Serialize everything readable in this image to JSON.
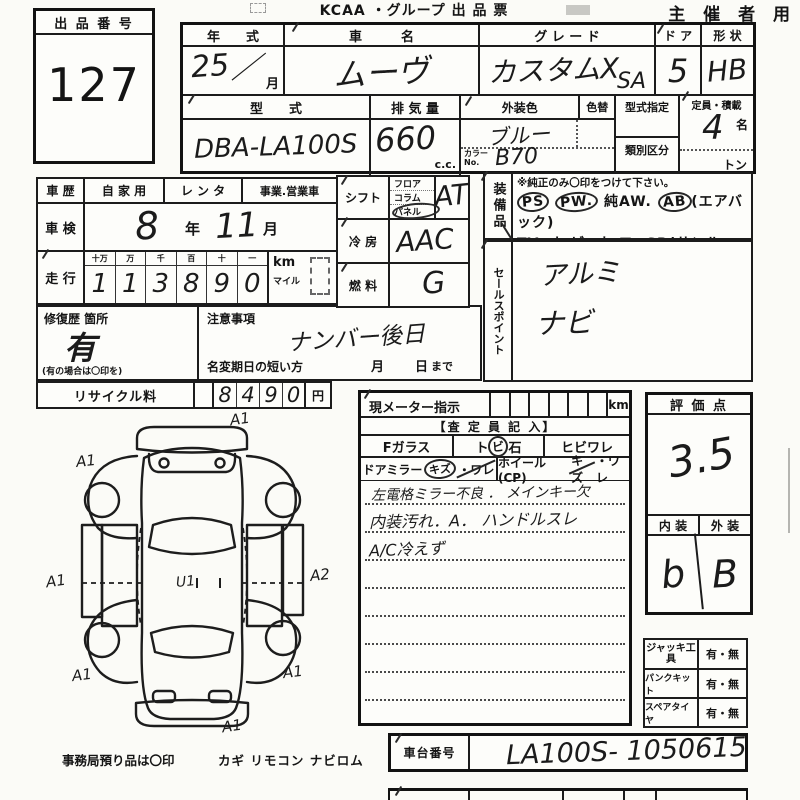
{
  "header": {
    "lot_label": "出 品 番 号",
    "lot_number": "127",
    "title": "KCAA ・グループ 出 品 票",
    "organizer": "主 催 者 用"
  },
  "vehicle": {
    "year_label": "年　　式",
    "year_value": "25",
    "year_slash": "／",
    "month_label": "月",
    "name_label": "車　　　名",
    "name_value": "ムーヴ",
    "grade_label": "グ レ ー ド",
    "grade_value": "カスタムX",
    "grade_sub": "SA",
    "door_label": "ド ア",
    "door_value": "5",
    "shape_label": "形 状",
    "shape_value": "HB",
    "model_label": "型　　式",
    "model_value": "DBA-LA100S",
    "disp_label": "排 気 量",
    "disp_value": "660",
    "disp_unit": "c.c.",
    "ext_color_label": "外装色",
    "color_change_label": "色替",
    "ext_color_value": "ブルー",
    "color_no_label1": "カラー",
    "color_no_label2": "No.",
    "color_no_value": "B70",
    "type_desig_label": "型式指定",
    "class_div_label": "類別区分",
    "capacity_label": "定員・積載",
    "capacity_value": "4",
    "capacity_unit": "名",
    "ton_label": "トン"
  },
  "history": {
    "label": "車 歴",
    "options": [
      "自 家 用",
      "レ ン タ",
      "事業.営業車"
    ],
    "shaken_label": "車 検",
    "shaken_year": "8",
    "shaken_year_unit": "年",
    "shaken_month": "11",
    "shaken_month_unit": "月",
    "mileage_label": "走 行",
    "mileage_cols": [
      "十万",
      "万",
      "千",
      "百",
      "十",
      "一"
    ],
    "mileage_digits": [
      "1",
      "1",
      "3",
      "8",
      "9",
      "0"
    ],
    "km_label": "km",
    "mile_label": "マイル"
  },
  "repair": {
    "label": "修復歴 箇所",
    "value": "有",
    "note": "(有の場合は〇印を)"
  },
  "caution": {
    "label": "注意事項",
    "value": "ナンバー後日",
    "rename_label": "名変期日の短い方",
    "month_label": "月",
    "day_label": "日",
    "made_label": "まで"
  },
  "recycle": {
    "label": "リサイクル料",
    "digits": [
      "8",
      "4",
      "9",
      "0"
    ],
    "unit": "円"
  },
  "controls": {
    "shift_label": "シフト",
    "shift_options": [
      "フロア",
      "コラム",
      "パネル"
    ],
    "shift_value": "AT",
    "ac_label": "冷 房",
    "ac_value": "AAC",
    "fuel_label": "燃 料",
    "fuel_value": "G"
  },
  "equipment": {
    "label": "装備品",
    "note": "※純正のみ〇印をつけて下さい。",
    "row1": [
      "PS",
      "PW.",
      "純AW.",
      "AB",
      "(エアバック)"
    ],
    "row2": [
      "TV.",
      "ナ ビ.",
      "カ ワ.",
      "SR(サンルーフ)"
    ],
    "row3": [
      "ABS",
      "・",
      "新車保証書←(注) 後日送りのみ"
    ]
  },
  "sales": {
    "label": "セールスポイント",
    "values": [
      "アルミ",
      "ナビ"
    ]
  },
  "meter": {
    "label": "現メーター指示",
    "unit": "km"
  },
  "assessor": {
    "header": "【査 定 員 記 入】",
    "fglass": "Fガラス",
    "stone1": "ト",
    "stone2": "ビ",
    "stone3": "石",
    "crack": "ヒビワレ",
    "mirror": "ドアミラー",
    "mirror_kizu": "キズ",
    "mirror_ware": "・ワレ",
    "wheel": "ホイール(CP)",
    "wheel_kizu": "キズ",
    "wheel_ware": "・ワレ",
    "notes": [
      "左電格ミラー不良 ． メインキー欠",
      "内装汚れ．A． ハンドルスレ",
      "A/C冷えず"
    ]
  },
  "rating": {
    "label": "評 価 点",
    "score": "3.5",
    "interior_label": "内 装",
    "exterior_label": "外 装",
    "interior_value": "b",
    "exterior_value": "B"
  },
  "accessories": {
    "rows": [
      {
        "label": "ジャッキ工具",
        "value": "有・無"
      },
      {
        "label": "パンクキット",
        "value": "有・無"
      },
      {
        "label": "スペアタイヤ",
        "value": "有・無"
      }
    ]
  },
  "chassis": {
    "label": "車台番号",
    "value": "LA100S- 1050615"
  },
  "office": {
    "note": "事務局預り品は〇印",
    "items": "カギ リモコン ナビロム"
  },
  "diagram": {
    "annotations": [
      "A1",
      "A1",
      "A1",
      "A2",
      "A1",
      "A1",
      "A1",
      "U1"
    ]
  }
}
